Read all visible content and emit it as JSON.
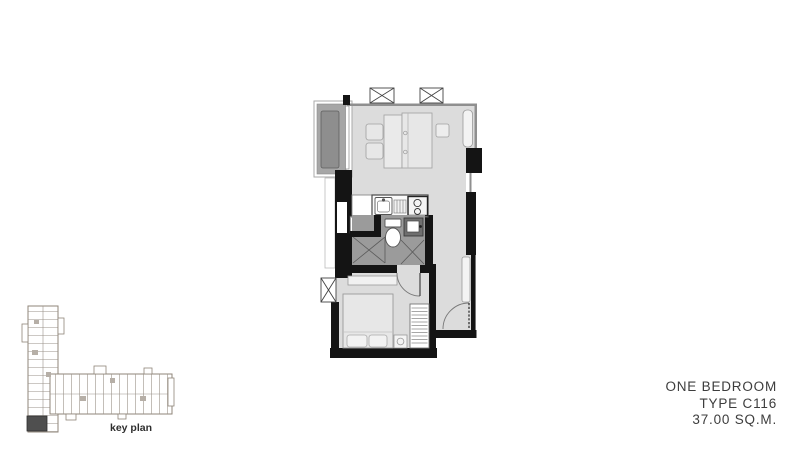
{
  "unit": {
    "type_label": "ONE BEDROOM",
    "type_code": "TYPE C116",
    "area": "37.00 SQ.M."
  },
  "key_plan": {
    "label": "key plan",
    "highlighted_unit": "C116 corner unit, bottom-left of L-shaped tower"
  },
  "colors": {
    "background": "#ffffff",
    "floor": "#dcdcdc",
    "wet_floor": "#9b9b9b",
    "balcony_floor": "#a6a6a6",
    "planter": "#8e8e8e",
    "wall": "#141414",
    "thin_wall_line": "#8f8f8f",
    "furniture_fill": "#e7e7e7",
    "furniture_stroke": "#9a9a9a",
    "text": "#3d3d3d",
    "keyplan_line": "#8f8579",
    "keyplan_highlight": "#4f4f4f"
  },
  "fixtures": [
    "window-icon",
    "balcony-planter",
    "sliding-door",
    "dining-chair",
    "dining-table",
    "sofa",
    "side-table",
    "wall-console",
    "kitchen-counter",
    "kitchen-sink",
    "dish-rack",
    "stove",
    "washing-machine",
    "toilet",
    "wash-basin",
    "shower",
    "bathroom-door-swing",
    "tv-shelf",
    "bed",
    "pillow",
    "bedside-table",
    "wardrobe",
    "shoe-cabinet",
    "entrance-door-swing",
    "bedroom-door-swing"
  ]
}
